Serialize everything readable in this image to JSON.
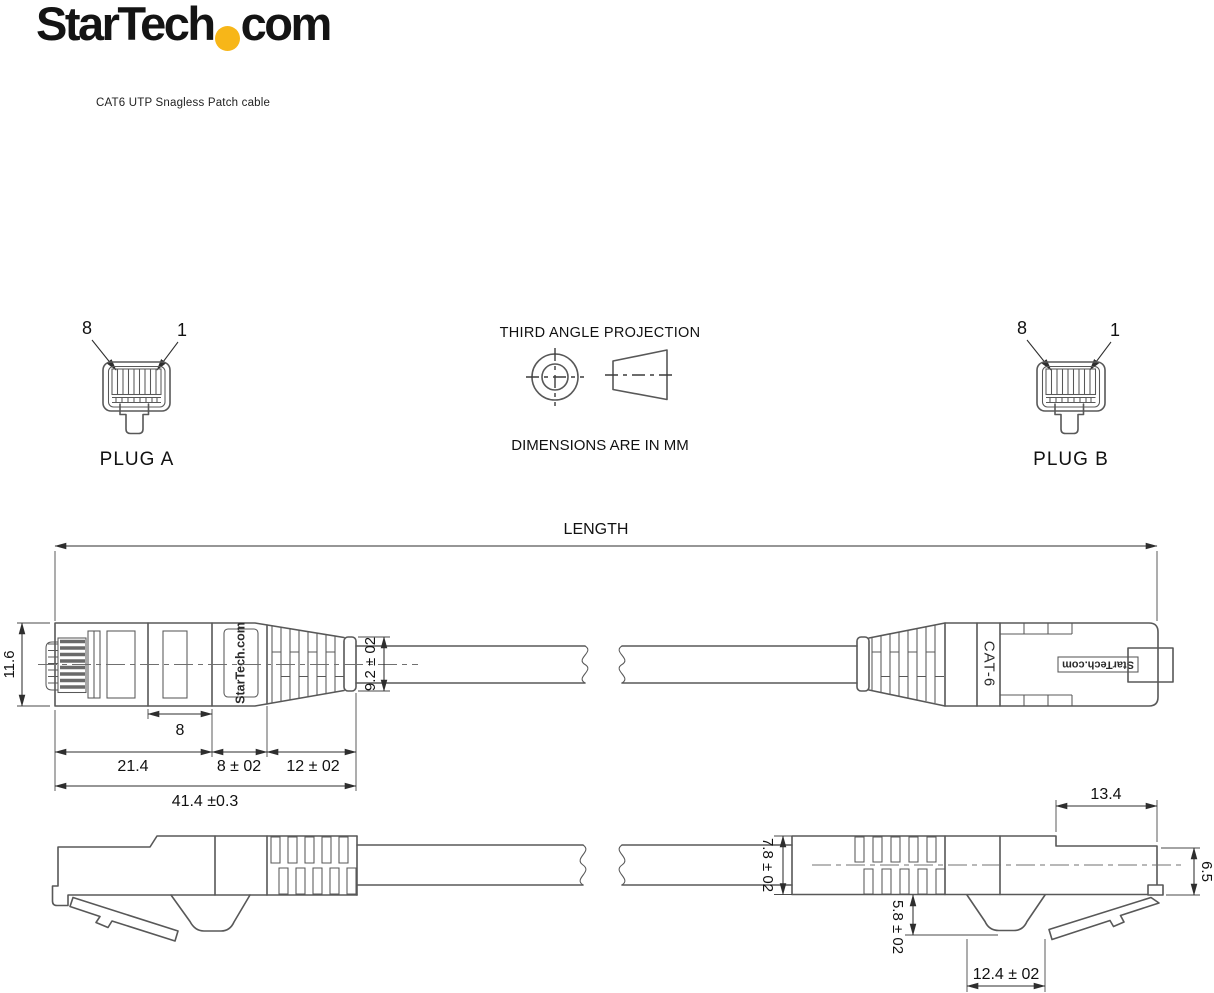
{
  "header": {
    "logo": {
      "prefix": "StarTech",
      "suffix": "com"
    },
    "subtitle": "CAT6 UTP Snagless Patch cable"
  },
  "projection": {
    "title": "THIRD ANGLE PROJECTION",
    "units": "DIMENSIONS ARE IN MM"
  },
  "plug_a": {
    "label": "PLUG A",
    "pin_left": "8",
    "pin_right": "1"
  },
  "plug_b": {
    "label": "PLUG B",
    "pin_left": "8",
    "pin_right": "1"
  },
  "length_dim": {
    "label": "LENGTH"
  },
  "top_view": {
    "height": "11.6",
    "contact_span": "8",
    "body_len": "21.4",
    "collar_len": "8 ± 02",
    "boot_len": "12 ± 02",
    "overall_len": "41.4 ±0.3",
    "boot_od": "9.2 ± 02",
    "brand_left": "StarTech.com",
    "cable_marking": "CAT-6",
    "brand_right": "StarTech.com"
  },
  "bottom_view": {
    "cable_od": "7.8 ± 02",
    "plug_front_len": "13.4",
    "plug_front_height": "6.5",
    "hood_depth": "5.8 ± 02",
    "hood_width": "12.4 ± 02"
  },
  "colors": {
    "accent": "#F7B618",
    "line": "#585858",
    "dim": "#2e2e2e",
    "text": "#111111"
  }
}
